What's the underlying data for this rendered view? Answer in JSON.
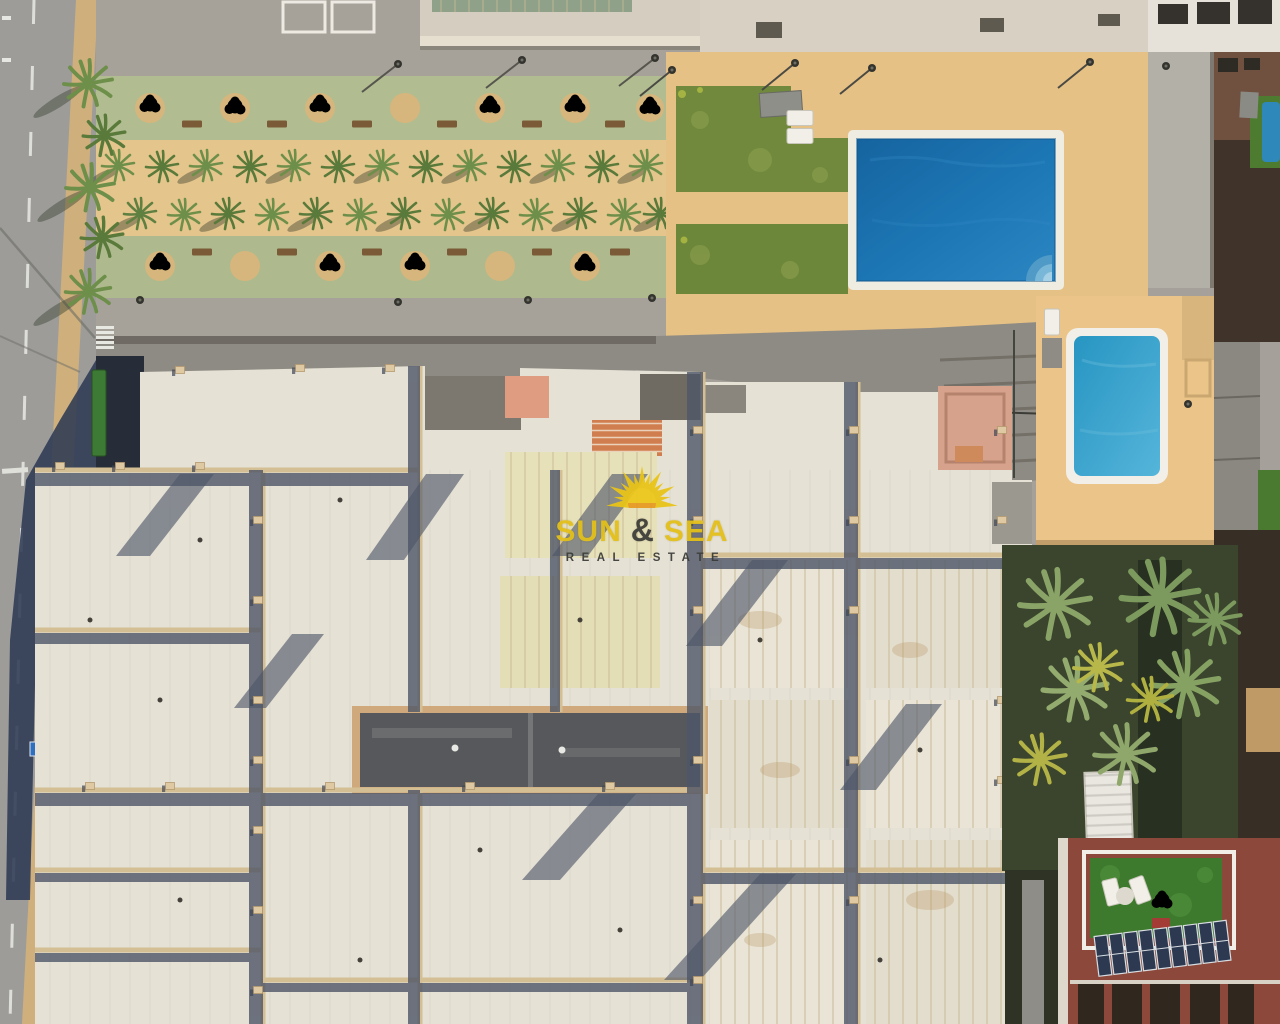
{
  "watermark": {
    "brand_word_1": "SUN",
    "brand_ampersand": "&",
    "brand_word_2": "SEA",
    "tagline": "REAL ESTATE"
  },
  "icons": {
    "logo": "sun-icon"
  },
  "colors": {
    "brand_yellow": "#e3c01a",
    "brand_orange": "#e89a22",
    "tagline_dark": "#3c3c38",
    "pool_deep_blue": "#1a6dad",
    "pool_teal": "#2f9cc8",
    "lawn_green": "#6f8a3d",
    "deck_tan": "#e6c185",
    "roof_white": "#e5e1d5",
    "shadow_navy": "#2e3a54",
    "turf_green": "#3e7a2d",
    "solar_navy": "#2c3950",
    "road_gray": "#9d9c99"
  }
}
